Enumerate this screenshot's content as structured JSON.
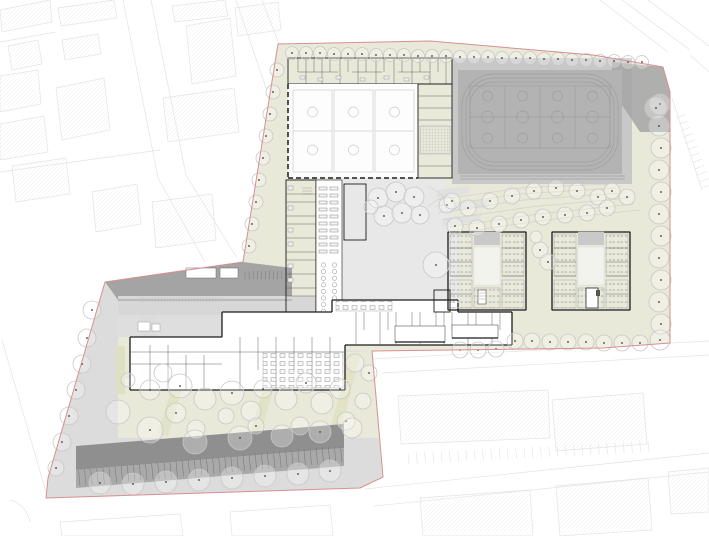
{
  "colors": {
    "background": "#ffffff",
    "boundary": "#d88f8f",
    "site_green": "#e9e9da",
    "plaza_gray": "#dcdcdc",
    "courtyard_gray": "#e8e8e8",
    "apron_gray": "#c8c8c8",
    "field_gray": "#b3b3b3",
    "field_line": "#9e9e9e",
    "roof_dark": "#a4a4a4",
    "roof_mid": "#c9c9c9",
    "roof_light": "#d7d7d7",
    "parking_dark": "#8f8f8f",
    "parking_mid": "#a9a9a9",
    "wall": "#1c1c1c",
    "partition": "#555555",
    "detail": "#888888",
    "context_line": "#e3e3e3",
    "tree_stroke": "#c7c7c7",
    "tree_dot": "#3a3a3a",
    "contour": "#d3d3c6",
    "court_line": "#cdcdcd",
    "garden_strip": "#e2e2c6"
  },
  "plan": {
    "trees": {
      "north_row": {
        "r": 6.5,
        "dot": true,
        "pts": [
          [
            292,
            53
          ],
          [
            306,
            53
          ],
          [
            320,
            53
          ],
          [
            334,
            54
          ],
          [
            348,
            54
          ],
          [
            362,
            54
          ],
          [
            376,
            55
          ],
          [
            390,
            55
          ],
          [
            404,
            55
          ],
          [
            418,
            56
          ],
          [
            432,
            56
          ],
          [
            446,
            56
          ],
          [
            460,
            57
          ],
          [
            474,
            57
          ],
          [
            488,
            57
          ],
          [
            502,
            58
          ],
          [
            516,
            58
          ],
          [
            530,
            58
          ],
          [
            544,
            59
          ],
          [
            558,
            59
          ],
          [
            572,
            60
          ],
          [
            586,
            60
          ],
          [
            600,
            61
          ],
          [
            614,
            61
          ],
          [
            628,
            62
          ],
          [
            642,
            62
          ]
        ]
      },
      "west_band": {
        "r": 7,
        "dot": true,
        "pts": [
          [
            277,
            70
          ],
          [
            273,
            92
          ],
          [
            270,
            114
          ],
          [
            266,
            136
          ],
          [
            263,
            158
          ],
          [
            259,
            180
          ],
          [
            256,
            202
          ],
          [
            252,
            224
          ],
          [
            249,
            246
          ]
        ]
      },
      "east_col": {
        "r": 10,
        "dot": true,
        "pts": [
          [
            660,
            104
          ],
          [
            659,
            126
          ],
          [
            661,
            148
          ],
          [
            659,
            170
          ],
          [
            661,
            192
          ],
          [
            659,
            214
          ],
          [
            661,
            236
          ],
          [
            659,
            258
          ],
          [
            661,
            280
          ],
          [
            659,
            302
          ],
          [
            661,
            324
          ],
          [
            660,
            340
          ]
        ]
      },
      "corner": {
        "r": 11,
        "dot": true,
        "pts": [
          [
            656,
            108
          ]
        ]
      },
      "south_row": {
        "r": 8,
        "dot": true,
        "pts": [
          [
            460,
            350
          ],
          [
            478,
            350
          ],
          [
            496,
            349
          ],
          [
            515,
            341
          ],
          [
            532,
            341
          ],
          [
            550,
            342
          ],
          [
            568,
            342
          ],
          [
            586,
            342
          ],
          [
            604,
            343
          ],
          [
            622,
            343
          ],
          [
            640,
            343
          ]
        ]
      },
      "terrace": {
        "r": 8,
        "dot": true,
        "pts": [
          [
            447,
            205
          ],
          [
            468,
            208
          ],
          [
            490,
            201
          ],
          [
            512,
            196
          ],
          [
            534,
            191
          ],
          [
            556,
            188
          ],
          [
            577,
            191
          ],
          [
            598,
            197
          ],
          [
            612,
            191
          ],
          [
            627,
            197
          ],
          [
            455,
            226
          ],
          [
            477,
            228
          ],
          [
            499,
            224
          ],
          [
            521,
            220
          ],
          [
            543,
            217
          ],
          [
            565,
            215
          ],
          [
            587,
            213
          ],
          [
            607,
            208
          ]
        ]
      },
      "courtyard": {
        "r": 10,
        "dot": true,
        "pts": [
          [
            378,
            198
          ],
          [
            396,
            192
          ],
          [
            414,
            197
          ],
          [
            384,
            216
          ],
          [
            402,
            213
          ],
          [
            420,
            215,
            9,
            1
          ],
          [
            452,
            201,
            8,
            1
          ],
          [
            436,
            265,
            13,
            1
          ],
          [
            371,
            207,
            7,
            0
          ]
        ]
      },
      "gap": {
        "r": 8,
        "dot": true,
        "pts": [
          [
            540,
            250
          ],
          [
            548,
            262
          ],
          [
            536,
            237,
            6,
            0
          ]
        ]
      },
      "garden": {
        "r": 10,
        "dot": true,
        "pts": [
          [
            150,
            390
          ],
          [
            163,
            373,
            9,
            0
          ],
          [
            180,
            386,
            12,
            1
          ],
          [
            176,
            413
          ],
          [
            205,
            399,
            11,
            0
          ],
          [
            232,
            393,
            12,
            1
          ],
          [
            251,
            411,
            10,
            0
          ],
          [
            263,
            389,
            9,
            1
          ],
          [
            286,
            399,
            11,
            0
          ],
          [
            306,
            383
          ],
          [
            322,
            403,
            11,
            0
          ],
          [
            340,
            389
          ],
          [
            355,
            363,
            9,
            0
          ],
          [
            300,
            426,
            9,
            0
          ],
          [
            256,
            426,
            8,
            1
          ],
          [
            196,
            429,
            9,
            0
          ],
          [
            226,
            416,
            8,
            0
          ],
          [
            346,
            421,
            9,
            1
          ],
          [
            363,
            401,
            8,
            0
          ],
          [
            369,
            373,
            8,
            1
          ],
          [
            128,
            380,
            7,
            0
          ]
        ]
      },
      "plaza": {
        "r": 9,
        "dot": true,
        "pts": [
          [
            92,
            310
          ],
          [
            87,
            338
          ],
          [
            82,
            364
          ],
          [
            76,
            390
          ],
          [
            69,
            416
          ],
          [
            62,
            442
          ],
          [
            56,
            468,
            8,
            1
          ],
          [
            118,
            412,
            12,
            0
          ],
          [
            150,
            430,
            13,
            1
          ],
          [
            195,
            442,
            12,
            0
          ],
          [
            240,
            438,
            12,
            1
          ],
          [
            282,
            436,
            11,
            0
          ],
          [
            320,
            432,
            11,
            1
          ],
          [
            352,
            428,
            10,
            0
          ],
          [
            100,
            483,
            11,
            1
          ],
          [
            133,
            484,
            11,
            1
          ],
          [
            166,
            482,
            11,
            1
          ],
          [
            199,
            480,
            11,
            1
          ],
          [
            232,
            478,
            11,
            1
          ],
          [
            265,
            476,
            11,
            1
          ],
          [
            298,
            474,
            11,
            1
          ],
          [
            330,
            471,
            11,
            1
          ]
        ]
      }
    },
    "ticks": {
      "parking": {
        "from": [
          80,
          486
        ],
        "to": [
          342,
          462
        ],
        "count": 44,
        "dx": -1.5,
        "dy": -16
      },
      "context_parking": {
        "from": [
          408,
          453
        ],
        "to": [
          648,
          441
        ],
        "count": 30,
        "dx": 1,
        "dy": 11
      },
      "right_parking": {
        "from": [
          676,
          118
        ],
        "to": [
          702,
          188
        ],
        "count": 12,
        "dx": 9.4,
        "dy": -3.5
      },
      "bike_racks": {
        "from": [
          245,
          271
        ],
        "to": [
          290,
          271
        ],
        "count": 12,
        "dx": 0,
        "dy": 8
      },
      "roof_hatch": {
        "from": [
          140,
          297
        ],
        "to": [
          222,
          297
        ],
        "count": 28,
        "dx": 0,
        "dy": 5
      }
    },
    "corridor": {
      "lockers": {
        "cols": [
          319,
          330
        ],
        "y0": 187,
        "step": 7,
        "count": 10,
        "w": 8,
        "h": 3
      },
      "stools": {
        "cols": [
          323.5,
          334.5
        ],
        "y0": 265,
        "step": 6.6,
        "count": 8,
        "r": 2.2
      }
    },
    "parking_strip": {
      "stall_count": 44
    },
    "sports": {
      "indoor_courts": 3,
      "outdoor_courts": 4,
      "track_lanes": 3
    }
  }
}
